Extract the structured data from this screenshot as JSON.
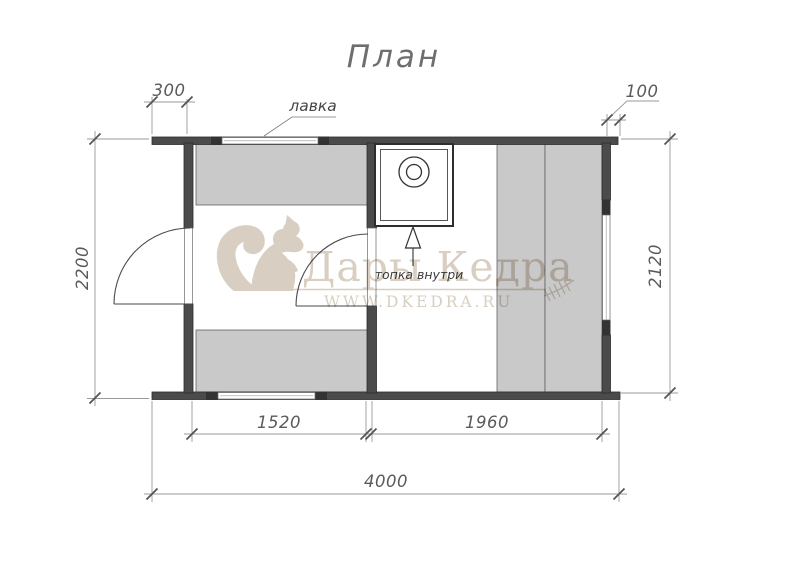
{
  "page": {
    "title": "План"
  },
  "labels": {
    "bench": "лавка",
    "stove": "топка внутри"
  },
  "dimensions": {
    "left_overhang": "300",
    "right_overhang": "100",
    "left_depth": "2200",
    "right_depth": "2120",
    "room_left_width": "1520",
    "room_right_width": "1960",
    "total_length": "4000"
  },
  "watermark": {
    "brand": "Дары Кедра",
    "site": "WWW.DKEDRA.RU"
  },
  "colors": {
    "wall": "#4b4b4b",
    "bench": "#c9c9c9",
    "dim_line": "#9a9a9a",
    "dim_text": "#5a5a5a",
    "watermark": "#d8cec1"
  }
}
